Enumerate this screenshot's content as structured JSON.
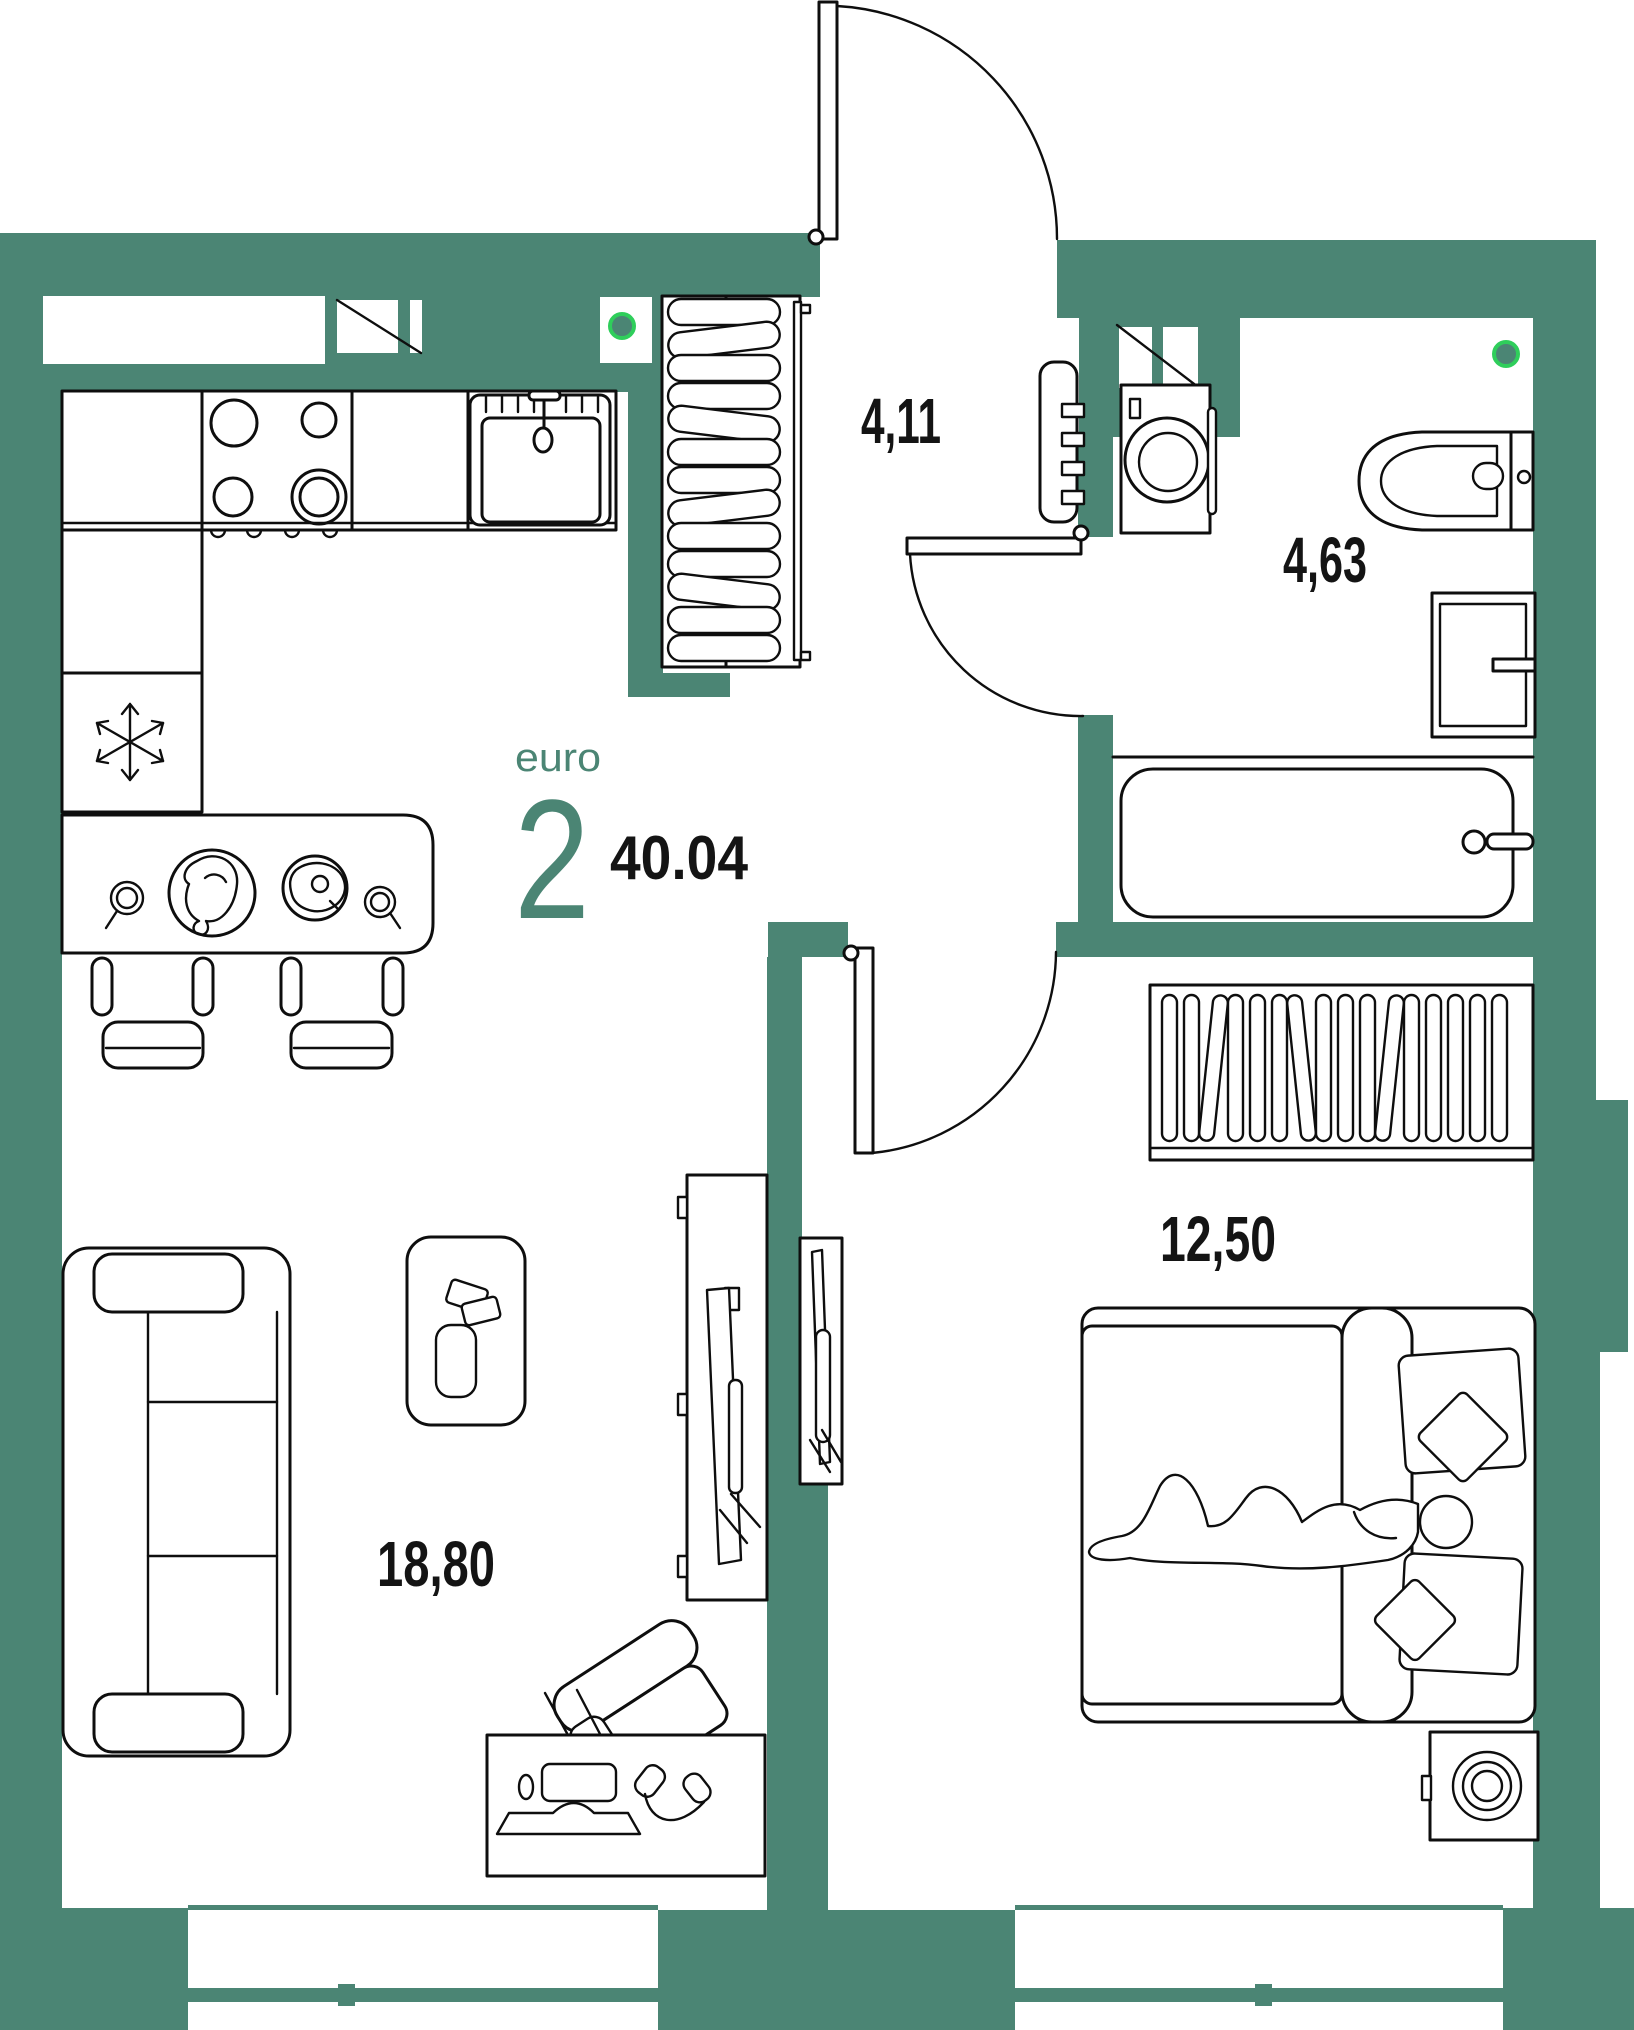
{
  "title": {
    "type_label": "euro",
    "rooms_count": "2",
    "total_area": "40.04"
  },
  "rooms": [
    {
      "name": "hallway",
      "area": "4,11"
    },
    {
      "name": "bathroom",
      "area": "4,63"
    },
    {
      "name": "bedroom",
      "area": "12,50"
    },
    {
      "name": "living-kitchen",
      "area": "18,80"
    }
  ],
  "colors": {
    "wall": "#4B8574",
    "line": "#0e0e0e",
    "accent": "#2FCE5B",
    "bg": "#ffffff",
    "text": "#141414"
  },
  "icons": {
    "freezer": "snowflake-icon",
    "stove": "four-burners-icon",
    "sink": "basin-with-faucet-icon",
    "ventilation": "crossed-duct-icon",
    "sockets": "green-dot-marker",
    "doors": "quarter-arc-swing"
  }
}
